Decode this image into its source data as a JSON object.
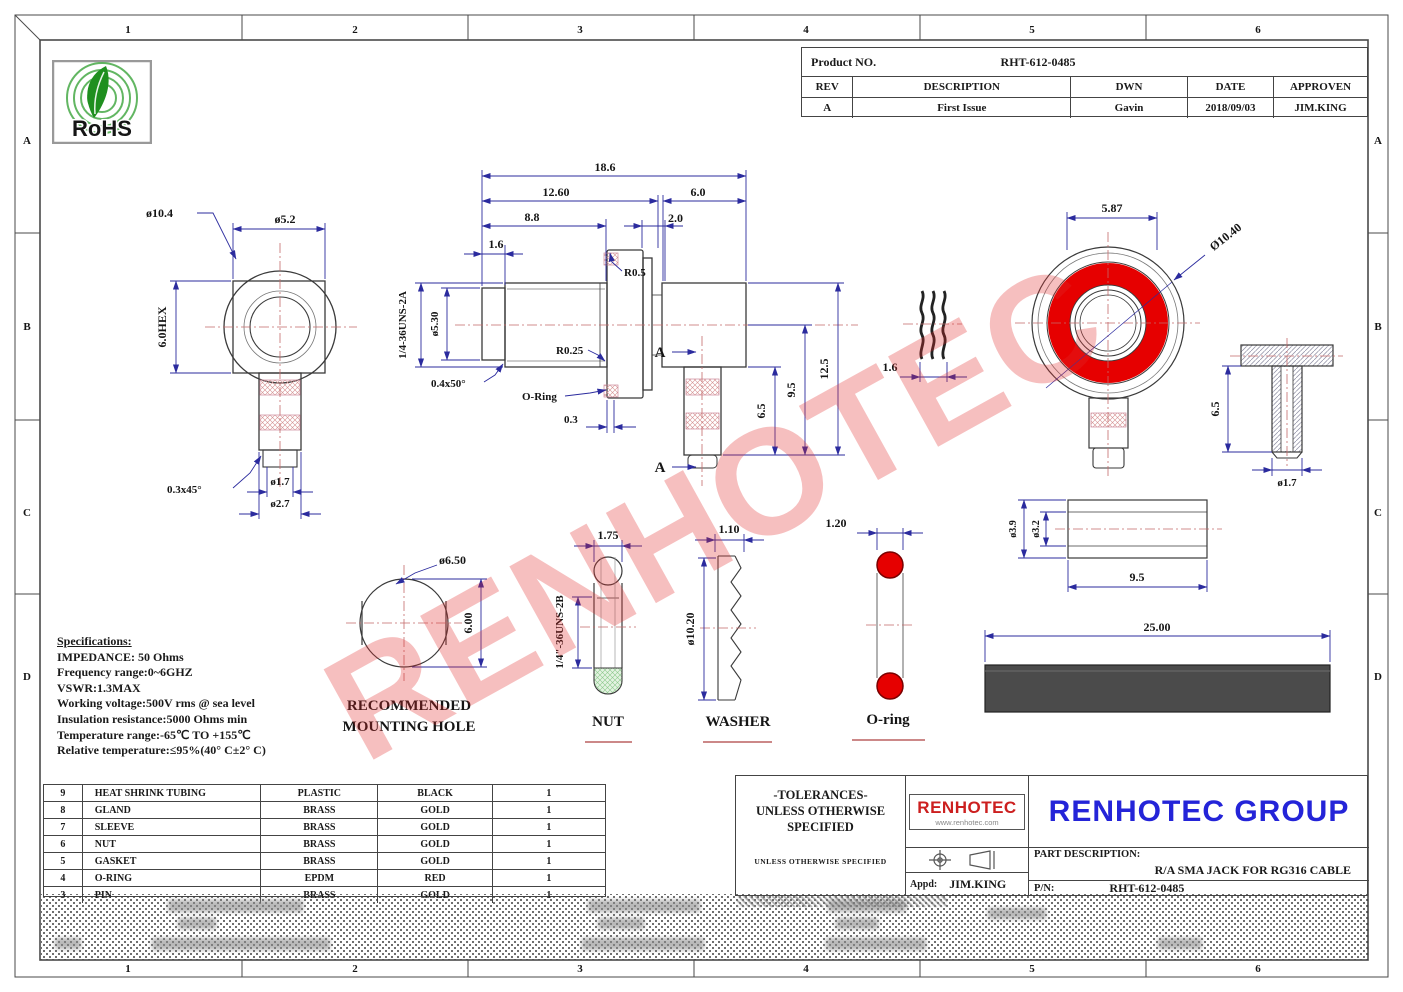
{
  "frame": {
    "cols": [
      "1",
      "2",
      "3",
      "4",
      "5",
      "6"
    ],
    "rows": [
      "A",
      "B",
      "C",
      "D"
    ]
  },
  "rohs": {
    "label": "RoHS"
  },
  "watermark": {
    "text": "RENHOTEC"
  },
  "product_table": {
    "label": "Product NO.",
    "number": "RHT-612-0485",
    "headers": [
      "REV",
      "DESCRIPTION",
      "DWN",
      "DATE",
      "APPROVEN"
    ],
    "row": {
      "rev": "A",
      "description": "First Issue",
      "dwn": "Gavin",
      "date": "2018/09/03",
      "approven": "JIM.KING"
    }
  },
  "front_view": {
    "dia_outer": "ø10.4",
    "dia_body": "ø5.2",
    "hex": "6.0HEX",
    "chamfer": "0.3x45°",
    "dia_pin": "ø1.7",
    "dia_barrel": "ø2.7"
  },
  "section_view": {
    "len_total": "18.6",
    "len_to_flange": "12.60",
    "len_rear": "6.0",
    "len_thread": "8.8",
    "len_gap": "2.0",
    "len_step": "1.6",
    "flange_radius": "R0.5",
    "dia_thread": "ø5.30",
    "thread_spec": "1/4-36UNS-2A",
    "root_radius": "R0.25",
    "chamfer": "0.4x50°",
    "oring_label": "O-Ring",
    "groove_width": "0.3",
    "h_barrel": "6.5",
    "h_axis": "9.5",
    "h_total": "12.5",
    "section_mark": "A"
  },
  "gasket_view": {
    "thickness": "1.6"
  },
  "rear_view": {
    "flat_width": "5.87",
    "dia_outer": "Ø10.40"
  },
  "pin_view": {
    "height": "6.5",
    "dia": "ø1.7"
  },
  "sleeve_view": {
    "dia_outer": "ø3.9",
    "dia_inner": "ø3.2",
    "length": "9.5"
  },
  "mounting_hole": {
    "dia": "ø6.50",
    "height": "6.00",
    "caption_line1": "RECOMMENDED",
    "caption_line2": "MOUNTING HOLE"
  },
  "nut_view": {
    "width": "1.75",
    "thread_spec": "1/4\"-36UNS-2B",
    "caption": "NUT"
  },
  "washer_view": {
    "thickness": "1.10",
    "dia": "ø10.20",
    "caption": "WASHER"
  },
  "oring_view": {
    "cs_dia": "1.20",
    "caption": "O-ring"
  },
  "tubing_view": {
    "length": "25.00"
  },
  "specs": {
    "title": "Specifications:",
    "lines": [
      "IMPEDANCE: 50 Ohms",
      "Frequency range:0~6GHZ",
      "VSWR:1.3MAX",
      "Working voltage:500V rms @ sea level",
      "Insulation resistance:5000 Ohms min",
      "Temperature range:-65℃ TO +155℃",
      "Relative temperature:≤95%(40° C±2° C)"
    ]
  },
  "parts_table": {
    "rows": [
      {
        "no": "9",
        "name": "HEAT SHRINK TUBING",
        "material": "PLASTIC",
        "finish": "BLACK",
        "qty": "1"
      },
      {
        "no": "8",
        "name": "GLAND",
        "material": "BRASS",
        "finish": "GOLD",
        "qty": "1"
      },
      {
        "no": "7",
        "name": "SLEEVE",
        "material": "BRASS",
        "finish": "GOLD",
        "qty": "1"
      },
      {
        "no": "6",
        "name": "NUT",
        "material": "BRASS",
        "finish": "GOLD",
        "qty": "1"
      },
      {
        "no": "5",
        "name": "GASKET",
        "material": "BRASS",
        "finish": "GOLD",
        "qty": "1"
      },
      {
        "no": "4",
        "name": "O-RING",
        "material": "EPDM",
        "finish": "RED",
        "qty": "1"
      },
      {
        "no": "3",
        "name": "PIN",
        "material": "BRASS",
        "finish": "GOLD",
        "qty": "1"
      }
    ]
  },
  "title_block": {
    "tolerances_line1": "-TOLERANCES-",
    "tolerances_line2": "UNLESS OTHERWISE",
    "tolerances_line3": "SPECIFIED",
    "small_note": "UNLESS OTHERWISE SPECIFIED",
    "logo_text": "RENHOTEC",
    "logo_url": "www.renhotec.com",
    "company": "RENHOTEC GROUP",
    "part_description_label": "PART DESCRIPTION:",
    "part_description": "R/A SMA JACK FOR RG316 CABLE",
    "appd_label": "Appd:",
    "appd": "JIM.KING",
    "pn_label": "P/N:",
    "pn": "RHT-612-0485"
  },
  "colors": {
    "accent_red": "#e60000",
    "dim_blue": "#2b2b9e",
    "group_blue": "#2424d8",
    "logo_red": "#cc1f1f",
    "green": "#2e9e2e"
  }
}
